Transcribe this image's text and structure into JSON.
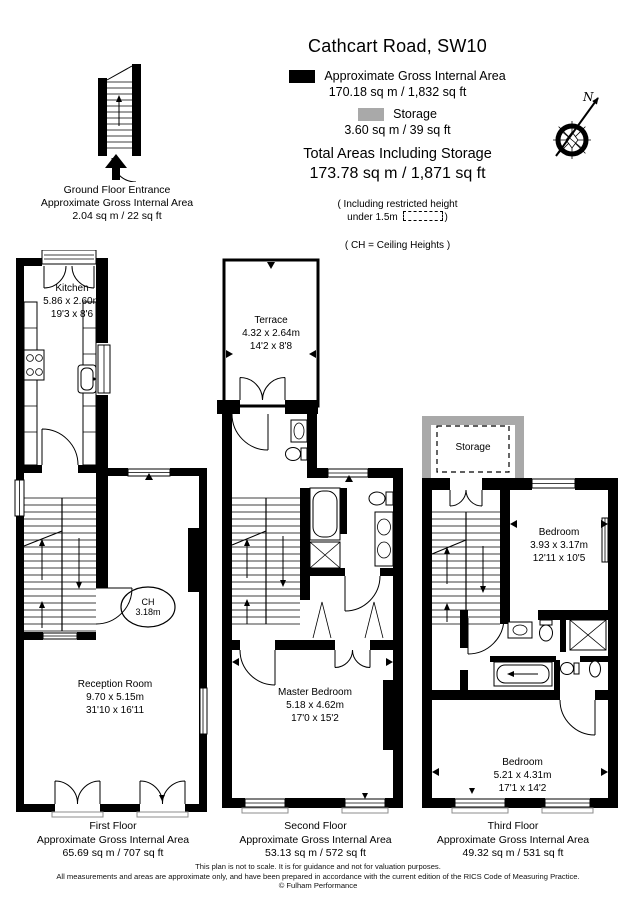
{
  "title": "Cathcart Road, SW10",
  "legend": {
    "items": [
      {
        "label": "Approximate Gross Internal Area",
        "value": "170.18 sq m / 1,832 sq ft",
        "swatch_color": "#000000"
      },
      {
        "label": "Storage",
        "value": "3.60 sq m / 39 sq ft",
        "swatch_color": "#a9a9a9"
      }
    ]
  },
  "totals": {
    "label": "Total Areas Including Storage",
    "value": "173.78 sq m / 1,871 sq ft",
    "note_line1": "( Including restricted height",
    "note_line2_text": "under 1.5m",
    "note_line2_close": ")",
    "ch_note": "( CH = Ceiling Heights )"
  },
  "compass": {
    "north_label": "N"
  },
  "entrance": {
    "caption_line1": "Ground Floor Entrance",
    "caption_line2": "Approximate Gross Internal Area",
    "caption_line3": "2.04 sq m / 22 sq ft"
  },
  "floors": {
    "first": {
      "rooms": {
        "kitchen": {
          "name": "Kitchen",
          "metric": "5.86 x 2.60m",
          "imperial": "19'3 x 8'6"
        },
        "reception": {
          "name": "Reception Room",
          "metric": "9.70 x 5.15m",
          "imperial": "31'10 x 16'11"
        },
        "ceiling_height": {
          "line1": "CH",
          "line2": "3.18m"
        }
      },
      "caption": {
        "line1": "First Floor",
        "line2": "Approximate Gross Internal Area",
        "line3": "65.69 sq m / 707 sq ft"
      }
    },
    "second": {
      "rooms": {
        "terrace": {
          "name": "Terrace",
          "metric": "4.32 x 2.64m",
          "imperial": "14'2 x 8'8"
        },
        "master_bedroom": {
          "name": "Master Bedroom",
          "metric": "5.18 x 4.62m",
          "imperial": "17'0 x 15'2"
        }
      },
      "caption": {
        "line1": "Second Floor",
        "line2": "Approximate Gross Internal Area",
        "line3": "53.13 sq m / 572 sq ft"
      }
    },
    "third": {
      "rooms": {
        "storage": {
          "name": "Storage"
        },
        "bedroom_rear": {
          "name": "Bedroom",
          "metric": "3.93 x 3.17m",
          "imperial": "12'11 x 10'5"
        },
        "bedroom_front": {
          "name": "Bedroom",
          "metric": "5.21 x 4.31m",
          "imperial": "17'1 x 14'2"
        }
      },
      "caption": {
        "line1": "Third Floor",
        "line2": "Approximate Gross Internal Area",
        "line3": "49.32 sq m / 531 sq ft"
      }
    }
  },
  "footer": {
    "line1": "This plan is not to scale. It is for guidance and not for valuation purposes.",
    "line2": "All measurements and areas are approximate only, and have been prepared in accordance with the current edition of the RICS Code of Measuring Practice.",
    "line3": "© Fulham Performance"
  }
}
